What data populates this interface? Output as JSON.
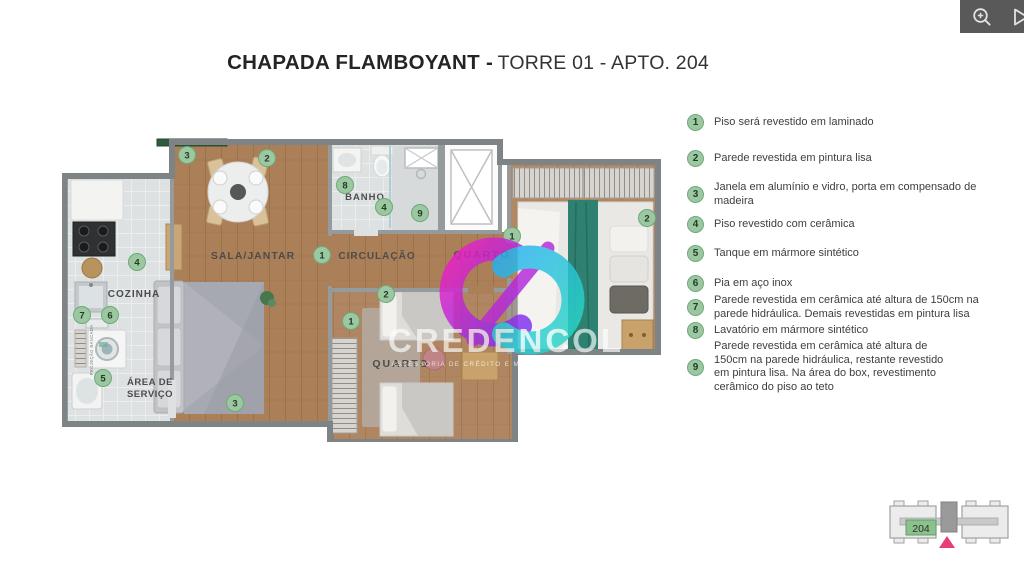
{
  "topbar": {
    "icons": [
      {
        "name": "zoom-in",
        "glyph": "magnifier-plus"
      },
      {
        "name": "next-page",
        "glyph": "triangle-right-outline"
      }
    ]
  },
  "title": {
    "project": "CHAPADA FLAMBOYANT -",
    "unit": "TORRE 01 - APTO. 204"
  },
  "plan": {
    "labels": {
      "living": "SALA/JANTAR",
      "kitchen": "COZINHA",
      "service1": "ÁREA DE",
      "service2": "SERVIÇO",
      "bath": "BANHO",
      "hall": "CIRCULAÇÃO",
      "bedroom1": "QUARTO",
      "bedroom2": "QUARTO",
      "bench": "PROJEÇÃO BANCADA"
    },
    "badges": {
      "living_window": "3",
      "living_wall": "2",
      "bath_sink": "8",
      "bath_floor": "4",
      "bath_wall": "9",
      "kitchen_floor": "4",
      "kitchen_wall": "7",
      "kitchen_sink": "6",
      "service_tank": "5",
      "hall_floor": "1",
      "bedroom1_floor": "1",
      "bedroom1_wall": "2",
      "bedroom2_wall": "2",
      "bedroom2_floor": "1",
      "living_door": "3"
    }
  },
  "legend": {
    "items": [
      {
        "num": "1",
        "text": "Piso será revestido em laminado"
      },
      {
        "num": "2",
        "text": "Parede revestida em pintura lisa"
      },
      {
        "num": "3",
        "text": "Janela em alumínio e vidro, porta em compensado de madeira"
      },
      {
        "num": "4",
        "text": "Piso revestido com cerâmica"
      },
      {
        "num": "5",
        "text": "Tanque em mármore sintético"
      },
      {
        "num": "6",
        "text": "Pia em aço inox"
      },
      {
        "num": "7",
        "text": "Parede revestida em cerâmica até altura de 150cm na parede hidráulica. Demais revestidas em pintura lisa"
      },
      {
        "num": "8",
        "text": "Lavatório em mármore sintético"
      },
      {
        "num": "9",
        "text": "Parede revestida em cerâmica até altura de 150cm na parede hidráulica, restante revestido em pintura lisa. Na área do box, revestimento cerâmico do piso ao teto"
      }
    ]
  },
  "watermark": {
    "brand": "CREDENCOL",
    "tagline": "ASSESSORIA DE CRÉDITO E MARKETING IMOBILIÁRIO",
    "creci": "CRECI J-6919"
  },
  "keyplan": {
    "unit": "204"
  },
  "colors": {
    "topbar": "#595959",
    "badge_fill": "#9cc8a1",
    "badge_border": "#74a87c",
    "highlight_green": "#8cc08c",
    "marker_pink": "#e83e77",
    "watermark_magenta": "#ee1fc0",
    "watermark_cyan": "#29c0ee",
    "wood_floor": "#ab8059",
    "tile_floor": "#dee1e2"
  }
}
